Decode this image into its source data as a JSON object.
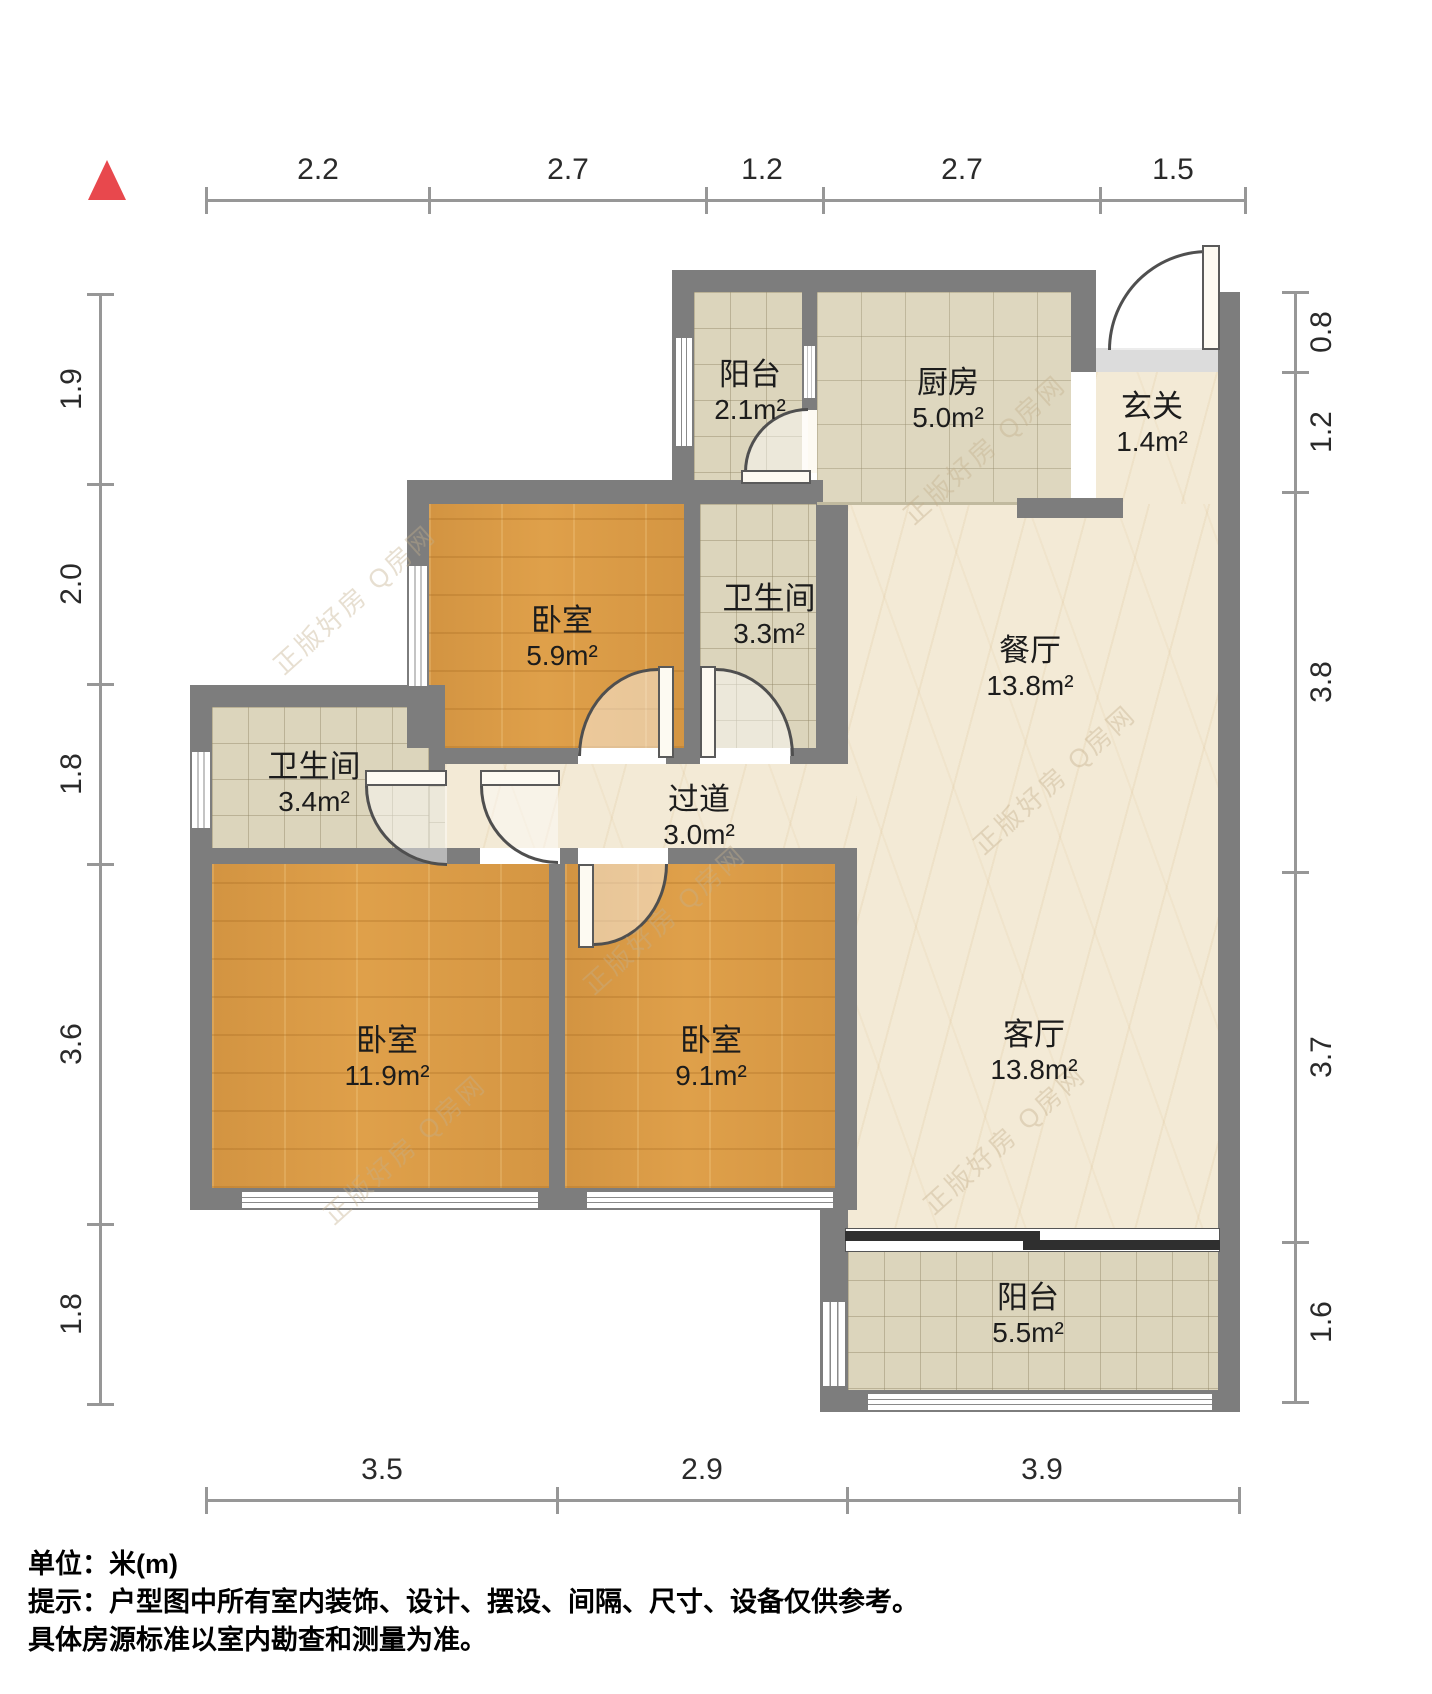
{
  "rooms": [
    {
      "name": "阳台",
      "area": "2.1m²"
    },
    {
      "name": "厨房",
      "area": "5.0m²"
    },
    {
      "name": "玄关",
      "area": "1.4m²"
    },
    {
      "name": "卧室",
      "area": "5.9m²"
    },
    {
      "name": "卫生间",
      "area": "3.3m²"
    },
    {
      "name": "餐厅",
      "area": "13.8m²"
    },
    {
      "name": "卫生间",
      "area": "3.4m²"
    },
    {
      "name": "过道",
      "area": "3.0m²"
    },
    {
      "name": "卧室",
      "area": "11.9m²"
    },
    {
      "name": "卧室",
      "area": "9.1m²"
    },
    {
      "name": "客厅",
      "area": "13.8m²"
    },
    {
      "name": "阳台",
      "area": "5.5m²"
    }
  ],
  "dimensions": {
    "top": [
      "2.2",
      "2.7",
      "1.2",
      "2.7",
      "1.5"
    ],
    "left": [
      "1.9",
      "2.0",
      "1.8",
      "3.6",
      "1.8"
    ],
    "right": [
      "0.8",
      "1.2",
      "3.8",
      "3.7",
      "1.6"
    ],
    "bottom": [
      "3.5",
      "2.9",
      "3.9"
    ]
  },
  "footer": {
    "unit_line": "单位：米(m)",
    "tip_line1": "提示：户型图中所有室内装饰、设计、摆设、间隔、尺寸、设备仅供参考。",
    "tip_line2": "具体房源标准以室内勘查和测量为准。"
  },
  "watermark": {
    "text": "正版好房 Q房网"
  },
  "colors": {
    "wall": "#7d7d7d",
    "wood_floor": "#dfa04a",
    "tile_floor": "#dcd5bc",
    "marble_floor": "#f3ead6",
    "north_arrow": "#e8484d",
    "sliding_door": "#2f2f2f"
  }
}
